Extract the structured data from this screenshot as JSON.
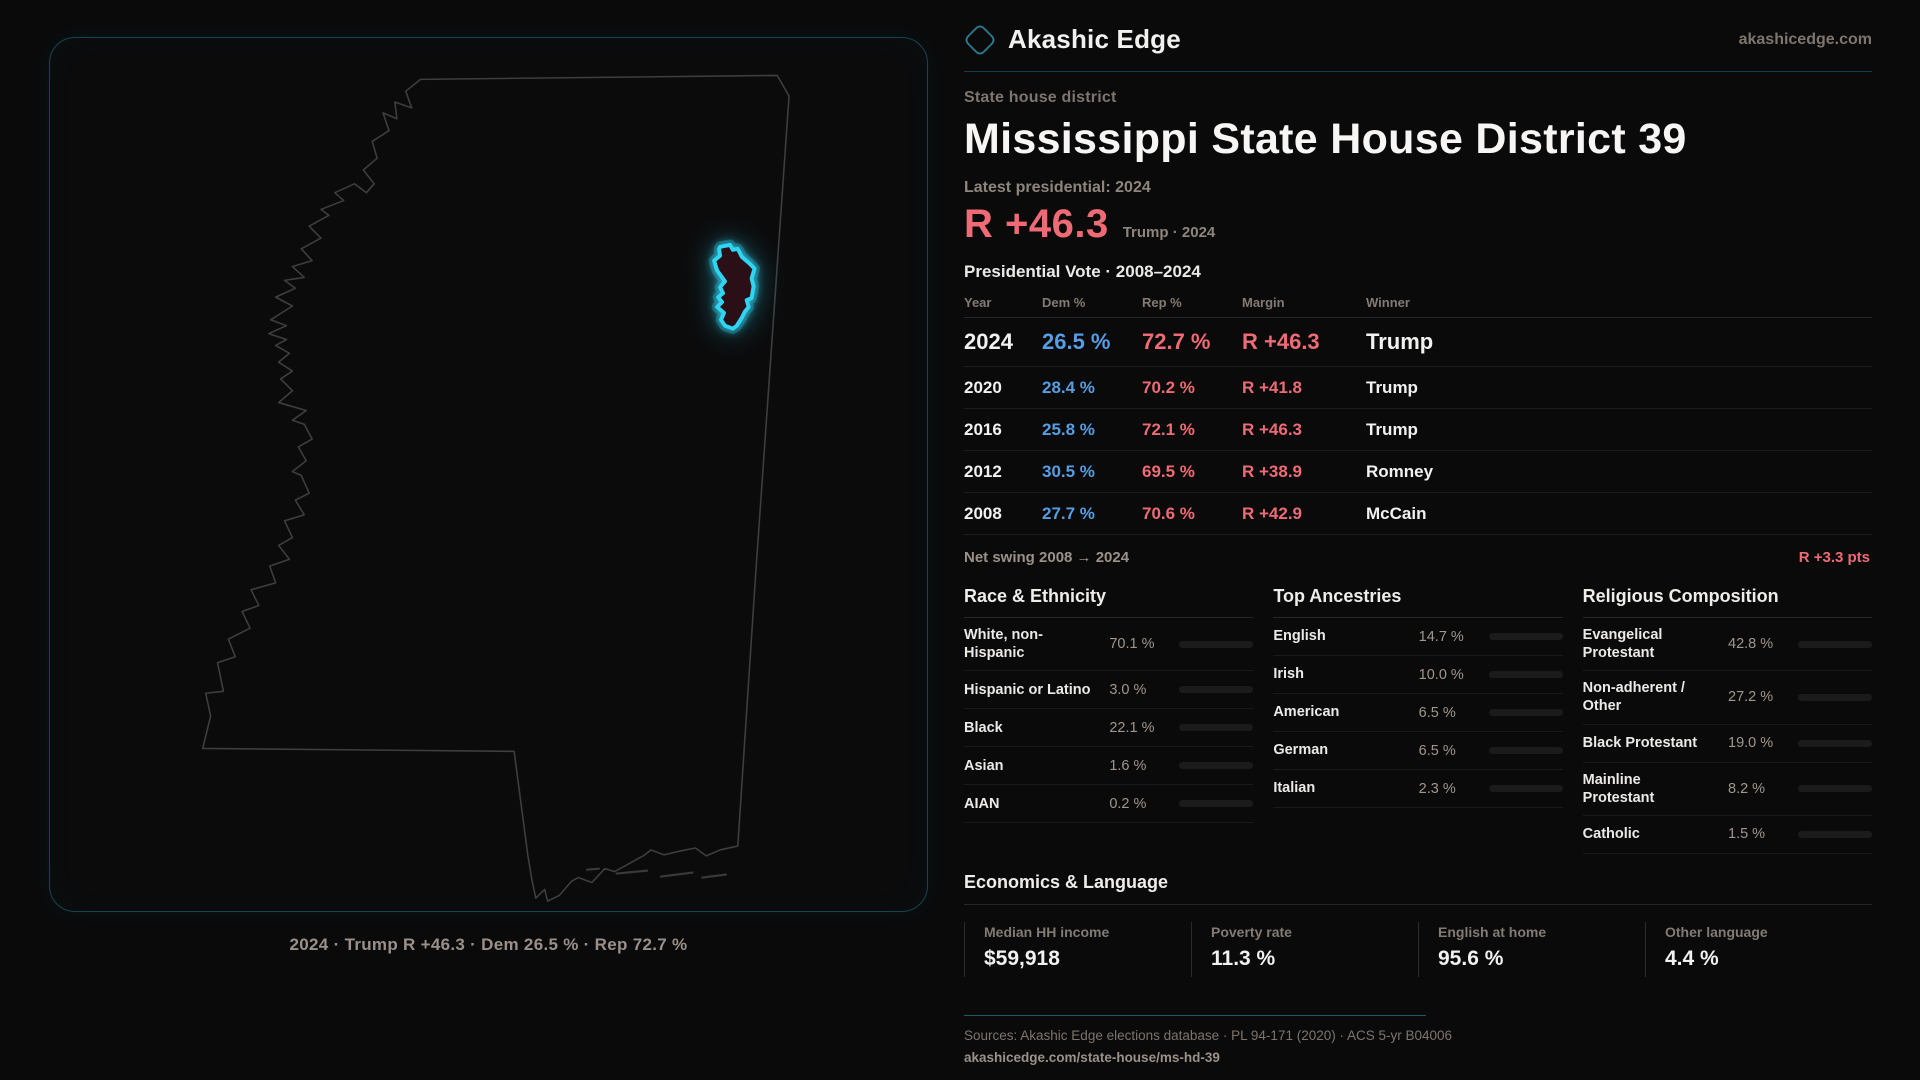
{
  "brand": {
    "name": "Akashic Edge",
    "site": "akashicedge.com"
  },
  "header": {
    "kicker": "State house district",
    "title": "Mississippi State House District 39",
    "latest_label": "Latest presidential: 2024",
    "margin_value": "R +46.3",
    "margin_caption": "Trump · 2024"
  },
  "map": {
    "caption": "2024 · Trump R +46.3 · Dem 26.5 % · Rep 72.7 %"
  },
  "vote_table": {
    "title": "Presidential Vote · 2008–2024",
    "columns": {
      "year": "Year",
      "dem": "Dem %",
      "rep": "Rep %",
      "margin": "Margin",
      "winner": "Winner"
    },
    "rows": [
      {
        "year": "2024",
        "dem": "26.5 %",
        "rep": "72.7 %",
        "margin": "R +46.3",
        "winner": "Trump"
      },
      {
        "year": "2020",
        "dem": "28.4 %",
        "rep": "70.2 %",
        "margin": "R +41.8",
        "winner": "Trump"
      },
      {
        "year": "2016",
        "dem": "25.8 %",
        "rep": "72.1 %",
        "margin": "R +46.3",
        "winner": "Trump"
      },
      {
        "year": "2012",
        "dem": "30.5 %",
        "rep": "69.5 %",
        "margin": "R +38.9",
        "winner": "Romney"
      },
      {
        "year": "2008",
        "dem": "27.7 %",
        "rep": "70.6 %",
        "margin": "R +42.9",
        "winner": "McCain"
      }
    ],
    "swing_label": "Net swing 2008 → 2024",
    "swing_value": "R +3.3 pts"
  },
  "demographics": {
    "race": {
      "title": "Race & Ethnicity",
      "rows": [
        {
          "label": "White, non-Hispanic",
          "value": "70.1 %",
          "pct": 70.1,
          "color": "#8fa3bd"
        },
        {
          "label": "Hispanic or Latino",
          "value": "3.0 %",
          "pct": 3.0,
          "color": "#e69a28"
        },
        {
          "label": "Black",
          "value": "22.1 %",
          "pct": 22.1,
          "color": "#8d78e0"
        },
        {
          "label": "Asian",
          "value": "1.6 %",
          "pct": 1.6,
          "color": "#2ec48f"
        },
        {
          "label": "AIAN",
          "value": "0.2 %",
          "pct": 0.2,
          "color": "#8fa3bd"
        }
      ]
    },
    "ancestries": {
      "title": "Top Ancestries",
      "rows": [
        {
          "label": "English",
          "value": "14.7 %",
          "pct": 14.7,
          "color": "#8fa3bd"
        },
        {
          "label": "Irish",
          "value": "10.0 %",
          "pct": 10.0,
          "color": "#8fa3bd"
        },
        {
          "label": "American",
          "value": "6.5 %",
          "pct": 6.5,
          "color": "#8fa3bd"
        },
        {
          "label": "German",
          "value": "6.5 %",
          "pct": 6.5,
          "color": "#8fa3bd"
        },
        {
          "label": "Italian",
          "value": "2.3 %",
          "pct": 2.3,
          "color": "#8fa3bd"
        }
      ]
    },
    "religion": {
      "title": "Religious Composition",
      "rows": [
        {
          "label": "Evangelical Protestant",
          "value": "42.8 %",
          "pct": 42.8,
          "color": "#e0606a"
        },
        {
          "label": "Non-adherent / Other",
          "value": "27.2 %",
          "pct": 27.2,
          "color": "#505b69"
        },
        {
          "label": "Black Protestant",
          "value": "19.0 %",
          "pct": 19.0,
          "color": "#8d78e0"
        },
        {
          "label": "Mainline Protestant",
          "value": "8.2 %",
          "pct": 8.2,
          "color": "#4a90d9"
        },
        {
          "label": "Catholic",
          "value": "1.5 %",
          "pct": 1.5,
          "color": "#d9a23c"
        }
      ]
    }
  },
  "economics": {
    "title": "Economics & Language",
    "stats": [
      {
        "label": "Median HH income",
        "value": "$59,918"
      },
      {
        "label": "Poverty rate",
        "value": "11.3 %"
      },
      {
        "label": "English at home",
        "value": "95.6 %"
      },
      {
        "label": "Other language",
        "value": "4.4 %"
      }
    ]
  },
  "footer": {
    "sources": "Sources: Akashic Edge elections database · PL 94-171 (2020) · ACS 5-yr B04006",
    "link": "akashicedge.com/state-house/ms-hd-39"
  },
  "colors": {
    "accent_teal": "#30d5f2",
    "rep_red": "#ee6b75",
    "dem_blue": "#559ee2"
  }
}
